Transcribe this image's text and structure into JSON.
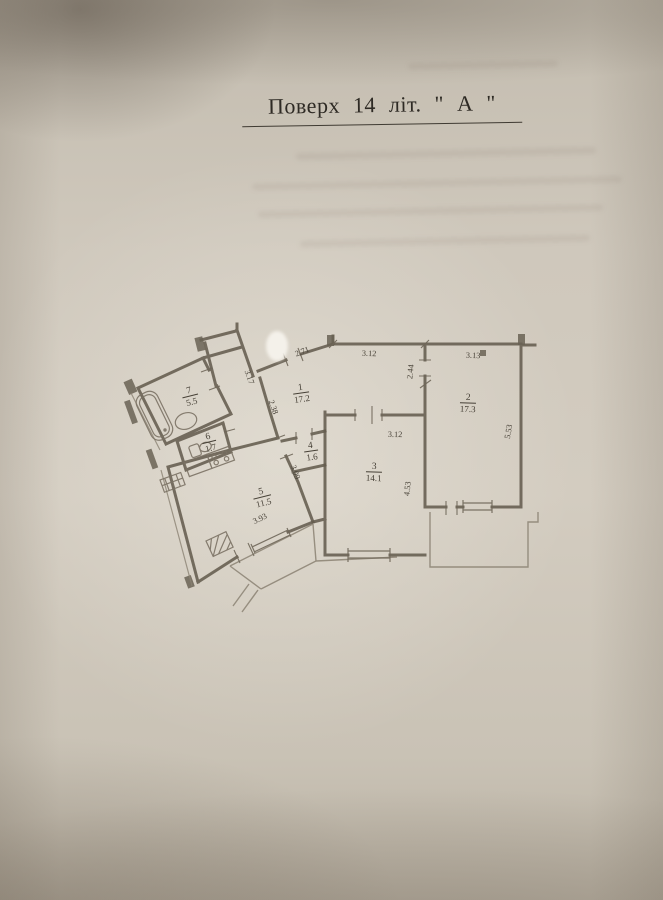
{
  "document": {
    "title": "Поверх 14 літ. \" А \""
  },
  "plan": {
    "rooms": [
      {
        "id": "1",
        "area": "17.2"
      },
      {
        "id": "2",
        "area": "17.3"
      },
      {
        "id": "3",
        "area": "14.1"
      },
      {
        "id": "4",
        "area": "1.6"
      },
      {
        "id": "5",
        "area": "11.5"
      },
      {
        "id": "6",
        "area": "1.7"
      },
      {
        "id": "7",
        "area": "5.5"
      }
    ],
    "dims": {
      "entry": "2.71",
      "entrySide": "3.17",
      "hallTop": "3.12",
      "hallRoom2": "2.44",
      "room2Top": "3.13",
      "room2Side": "5.53",
      "room3Top": "3.12",
      "room3Side": "4.53",
      "innerUpper": "2.38",
      "innerLower": "3.09",
      "kitchenBottom": "3.93"
    }
  }
}
